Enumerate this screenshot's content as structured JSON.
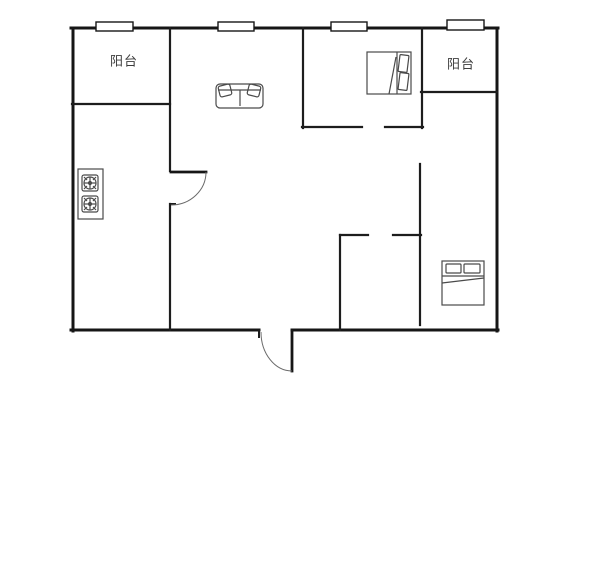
{
  "canvas": {
    "width": 600,
    "height": 584,
    "background": "#ffffff"
  },
  "colors": {
    "wall": "#161616",
    "inner_wall": "#1d1d1d",
    "furniture": "#4a4a4a",
    "door_arc": "#6a6a6a",
    "window_fill": "#ffffff",
    "label": "#3c3c3c"
  },
  "rooms": [
    {
      "id": "balcony-left",
      "label": "阳台",
      "cx": 124,
      "cy": 60
    },
    {
      "id": "balcony-right",
      "label": "阳台",
      "cx": 461,
      "cy": 63
    }
  ],
  "walls": {
    "outer": [
      [
        71,
        28,
        498,
        28
      ],
      [
        73,
        28,
        73,
        331
      ],
      [
        497,
        28,
        497,
        331
      ],
      [
        71,
        330,
        259,
        330
      ],
      [
        292,
        330,
        498,
        330
      ]
    ],
    "inner": [
      [
        170,
        28,
        170,
        171
      ],
      [
        170,
        204,
        170,
        330
      ],
      [
        72,
        104,
        170,
        104
      ],
      [
        303,
        28,
        303,
        128
      ],
      [
        302,
        127,
        362,
        127
      ],
      [
        385,
        127,
        423,
        127
      ],
      [
        422,
        28,
        422,
        128
      ],
      [
        421,
        92,
        497,
        92
      ],
      [
        420,
        164,
        420,
        325
      ],
      [
        340,
        235,
        368,
        235
      ],
      [
        393,
        235,
        421,
        235
      ],
      [
        340,
        235,
        340,
        330
      ]
    ],
    "ticks": [
      [
        170,
        204,
        175,
        204
      ],
      [
        259,
        331,
        259,
        337
      ],
      [
        292,
        331,
        292,
        338
      ]
    ]
  },
  "windows": [
    [
      96,
      22,
      37,
      9
    ],
    [
      218,
      22,
      36,
      9
    ],
    [
      331,
      22,
      36,
      9
    ],
    [
      447,
      20,
      37,
      10
    ]
  ],
  "doors": [
    {
      "leaf": [
        171,
        172,
        206,
        172
      ],
      "arc": "M 206 172 A 35 33 0 0 1 171 205"
    },
    {
      "leaf": [
        292,
        332,
        292,
        371
      ],
      "arc": "M 292 371 A 31 39 0 0 1 261 332"
    }
  ],
  "furniture": [
    {
      "name": "sofa-icon",
      "shapes": [
        [
          "rect",
          216,
          84,
          47,
          24,
          4,
          0
        ],
        [
          "line",
          218,
          90,
          261,
          90
        ],
        [
          "line",
          240,
          90,
          240,
          106
        ],
        [
          "rect",
          219,
          85,
          12,
          11,
          2,
          -14
        ],
        [
          "rect",
          248,
          85,
          12,
          11,
          2,
          14
        ]
      ]
    },
    {
      "name": "double-bed-icon",
      "shapes": [
        [
          "rect",
          367,
          52,
          44,
          42,
          0,
          0
        ],
        [
          "line",
          397,
          52,
          397,
          94
        ],
        [
          "rect",
          399,
          55,
          9,
          17,
          1,
          7
        ],
        [
          "rect",
          399,
          73,
          9,
          17,
          1,
          7
        ],
        [
          "line",
          396,
          57,
          389,
          94
        ]
      ]
    },
    {
      "name": "double-bed-icon",
      "shapes": [
        [
          "rect",
          442,
          261,
          42,
          44,
          0,
          0
        ],
        [
          "rect",
          446,
          264,
          15,
          9,
          1,
          0
        ],
        [
          "rect",
          464,
          264,
          16,
          9,
          1,
          0
        ],
        [
          "line",
          442,
          276,
          484,
          276
        ],
        [
          "line",
          442,
          283,
          484,
          278
        ]
      ]
    },
    {
      "name": "gas-stove-icon",
      "shapes": [
        [
          "rect",
          78,
          169,
          25,
          50,
          0,
          0
        ],
        [
          "rect",
          82,
          175,
          16,
          16,
          2,
          0
        ],
        [
          "circle",
          90,
          183,
          6
        ],
        [
          "circle",
          90,
          183,
          1.5
        ],
        [
          "line",
          84,
          177,
          87,
          180
        ],
        [
          "line",
          96,
          177,
          93,
          180
        ],
        [
          "line",
          84,
          189,
          87,
          186
        ],
        [
          "line",
          96,
          189,
          93,
          186
        ],
        [
          "line",
          84,
          183,
          96,
          183
        ],
        [
          "line",
          90,
          177,
          90,
          189
        ],
        [
          "rect",
          82,
          196,
          16,
          16,
          2,
          0
        ],
        [
          "circle",
          90,
          204,
          6
        ],
        [
          "circle",
          90,
          204,
          1.5
        ],
        [
          "line",
          84,
          198,
          87,
          201
        ],
        [
          "line",
          96,
          198,
          93,
          201
        ],
        [
          "line",
          84,
          210,
          87,
          207
        ],
        [
          "line",
          96,
          210,
          93,
          207
        ],
        [
          "line",
          84,
          204,
          96,
          204
        ],
        [
          "line",
          90,
          198,
          90,
          210
        ]
      ]
    }
  ]
}
